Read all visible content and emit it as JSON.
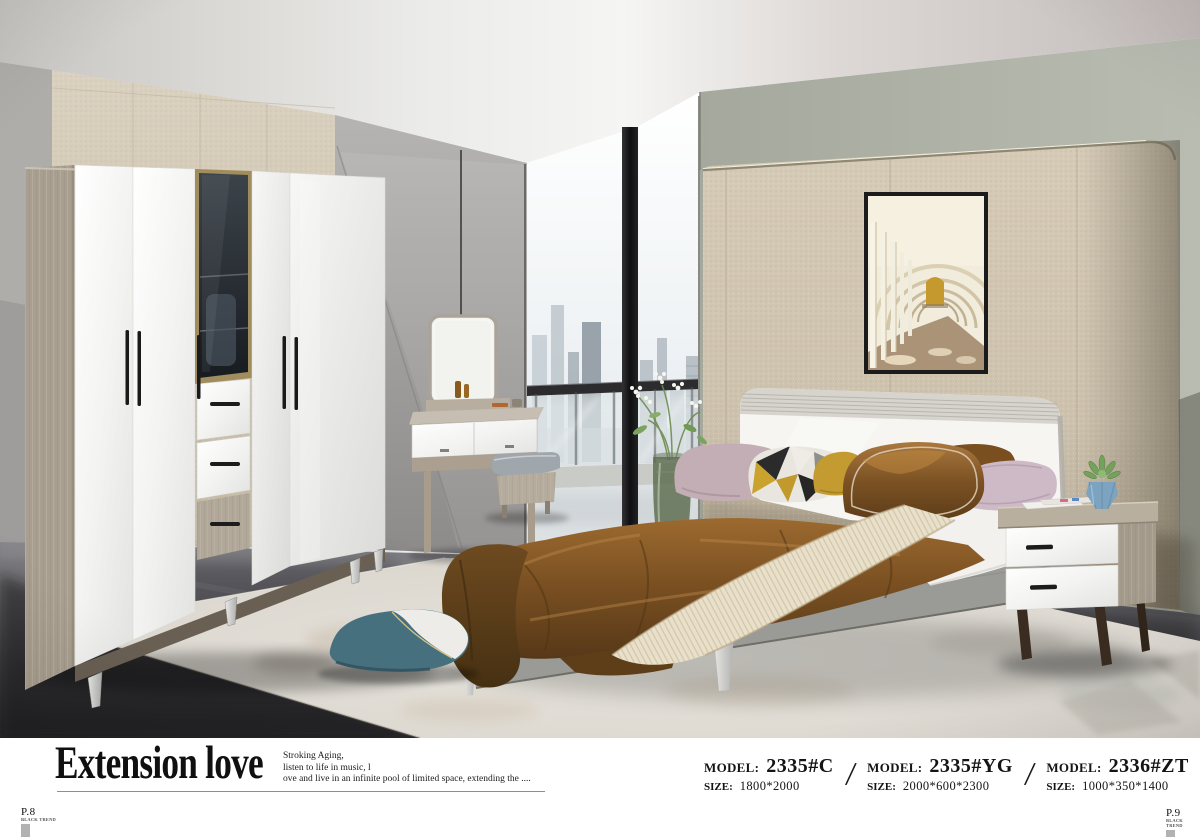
{
  "caption": {
    "title": "Extension love",
    "description_lines": [
      "Stroking Aging,",
      "listen to life in music, l",
      "ove and live in an infinite pool of limited space, extending the ...."
    ],
    "separator": "/",
    "models": [
      {
        "model_label": "MODEL:",
        "model_value": "2335#C",
        "size_label": "SIZE:",
        "size_value": "1800*2000"
      },
      {
        "model_label": "MODEL:",
        "model_value": "2335#YG",
        "size_label": "SIZE:",
        "size_value": "2000*600*2300"
      },
      {
        "model_label": "MODEL:",
        "model_value": "2336#ZT",
        "size_label": "SIZE:",
        "size_value": "1000*350*1400"
      }
    ],
    "page_left": {
      "number": "P.8",
      "tagline": "BLACK TREND"
    },
    "page_right": {
      "number": "P.9",
      "tagline": "BLACK TREND"
    }
  },
  "colors": {
    "blanket_brown": "#7a5022",
    "teal_pillow": "#47707e",
    "mustard_pillow": "#c39b31",
    "feature_wall_beige": "#cfc5b1",
    "rug": "#dbd7cf",
    "floor_dark": "#3a393d"
  }
}
